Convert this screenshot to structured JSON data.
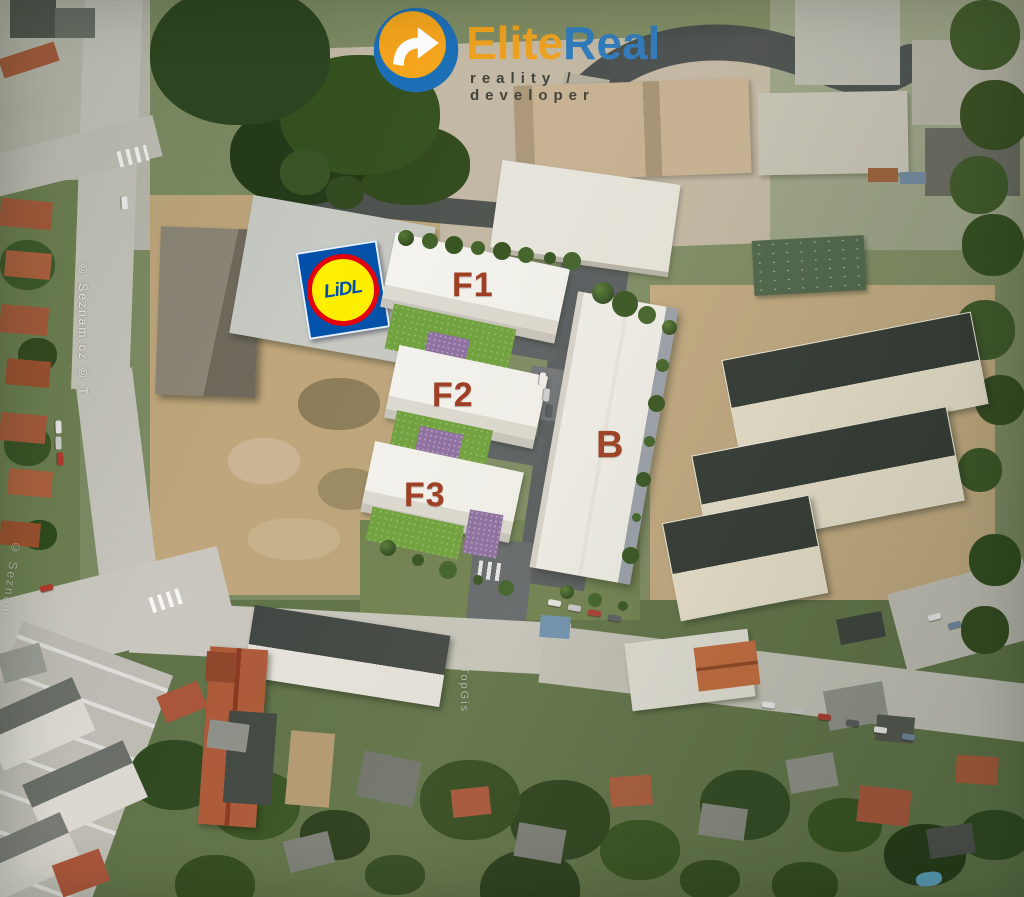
{
  "branding": {
    "icon": "elitereal-globe-arrow-icon",
    "name_orange": "Elite",
    "name_blue": "Real",
    "tagline": "reality / developer",
    "color_orange": "#F0A21E",
    "color_blue": "#2B7ABF"
  },
  "site_plan": {
    "label_color": "#9C3A20",
    "buildings": [
      {
        "label": "F1"
      },
      {
        "label": "F2"
      },
      {
        "label": "F3"
      },
      {
        "label": "B"
      }
    ],
    "store": {
      "name": "Lidl",
      "wordmark": "LiDL",
      "color_blue": "#0050AA",
      "color_yellow": "#FFF000",
      "color_red": "#E3000B"
    }
  },
  "watermarks": {
    "left_upper": "© Seznam.cz © T",
    "left_lower": "© Seznam",
    "road": "© TopGis"
  }
}
